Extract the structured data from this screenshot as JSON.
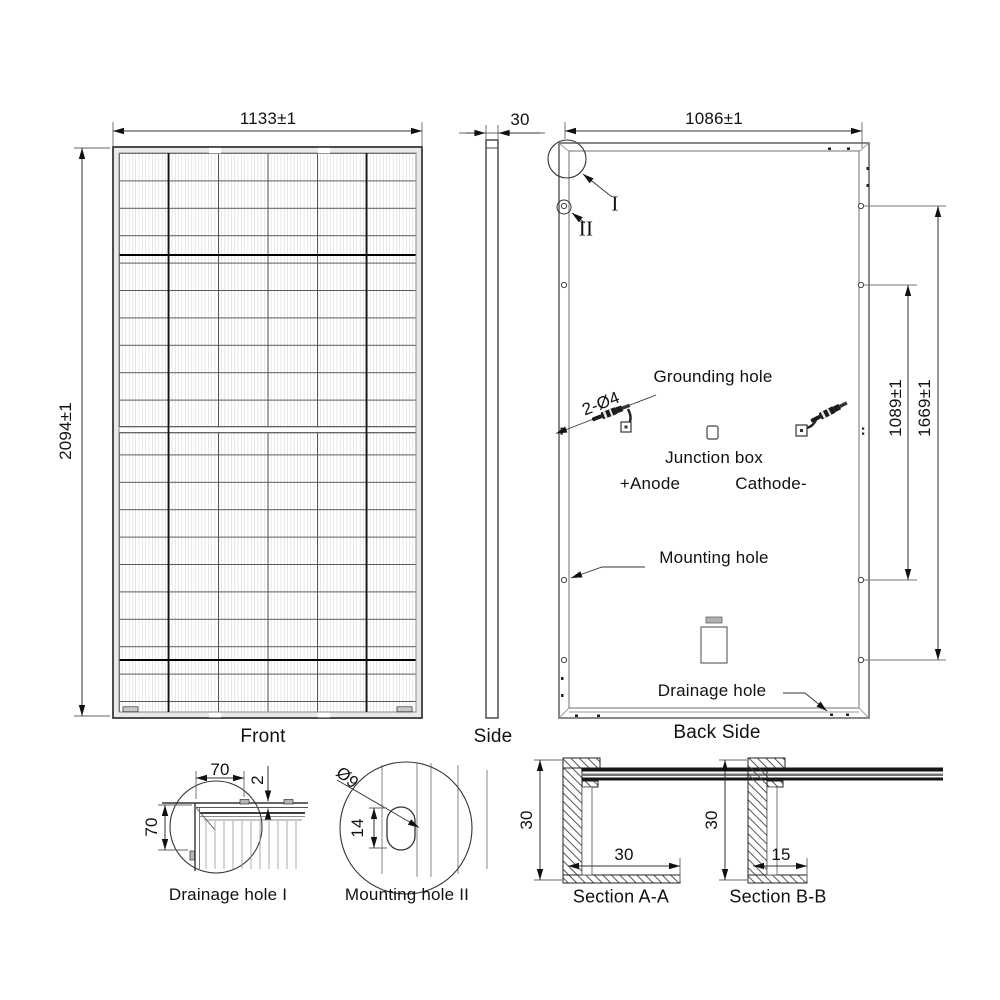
{
  "front": {
    "caption": "Front",
    "width": "1133±1",
    "height": "2094±1"
  },
  "side": {
    "caption": "Side",
    "thickness": "30"
  },
  "back": {
    "caption": "Back Side",
    "width": "1086±1",
    "inner_span": "1089±1",
    "outer_span": "1669±1",
    "hole_note": "2-Ø4",
    "detail_i": "I",
    "detail_ii": "II",
    "grounding": "Grounding hole",
    "junction": "Junction box",
    "anode": "+Anode",
    "cathode": "Cathode-",
    "mounting": "Mounting hole",
    "drainage": "Drainage hole"
  },
  "detail_drainage": {
    "caption": "Drainage hole I",
    "width": "70",
    "height": "70",
    "step": "2"
  },
  "detail_mounting": {
    "caption": "Mounting hole II",
    "diameter": "Ø9",
    "length": "14"
  },
  "section_aa": {
    "caption": "Section A-A",
    "height": "30",
    "flange": "30"
  },
  "section_bb": {
    "caption": "Section B-B",
    "height": "30",
    "flange": "15"
  }
}
